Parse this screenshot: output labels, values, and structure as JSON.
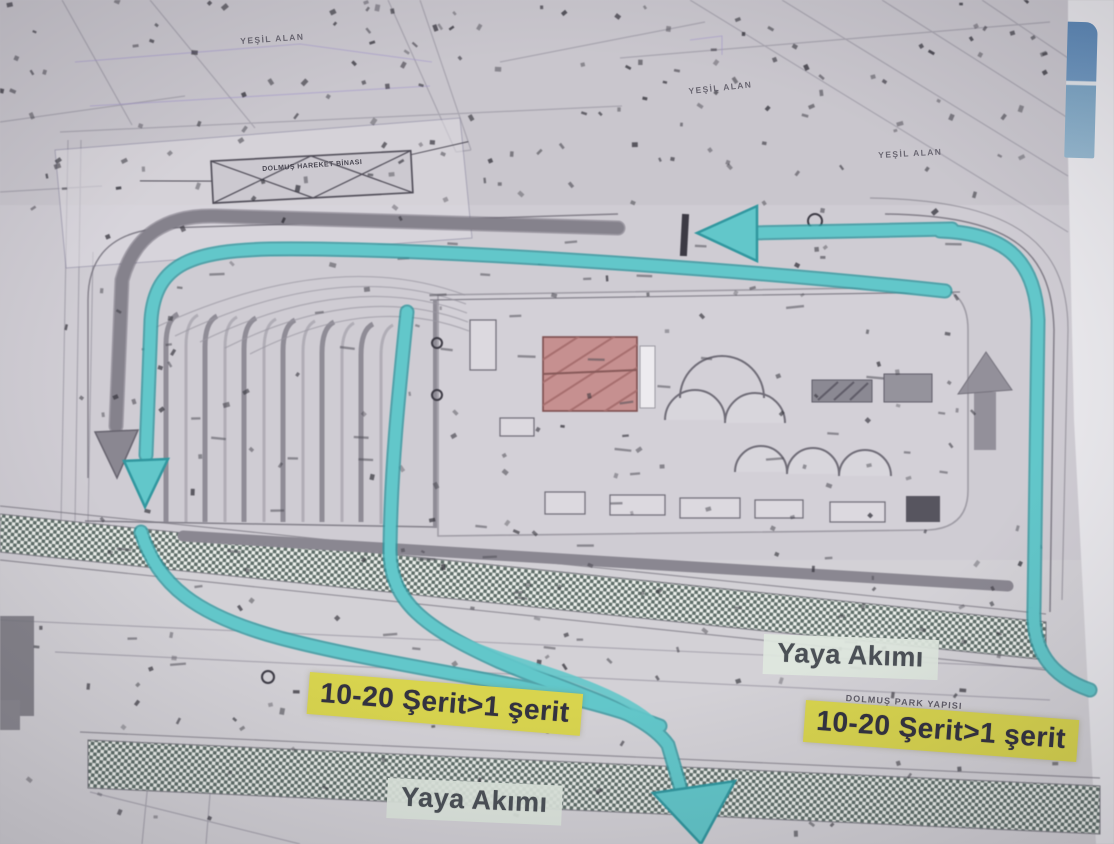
{
  "slide": {
    "plan_labels": {
      "green_area_top_left": "YEŞİL ALAN",
      "green_area_top_center": "YEŞİL ALAN",
      "green_area_top_right": "YEŞİL ALAN",
      "terminal_building": "DOLMUŞ HAREKET BİNASI",
      "parking_structure": "DOLMUŞ PARK YAPISI"
    },
    "annotations": {
      "lane_reduction_left": "10-20 Şerit>1 şerit",
      "lane_reduction_right": "10-20 Şerit>1 şerit",
      "pedestrian_flow_right": "Yaya Akımı",
      "pedestrian_flow_bottom": "Yaya Akımı"
    },
    "colors": {
      "flow_arrow": "#5fc8cb",
      "flow_arrow_edge": "#2e98a0",
      "road_arrow_gray": "#8a8791",
      "lane_label_bg": "#d8d44e",
      "lane_label_text": "#333240",
      "pedestrian_label_bg": "#dee7de",
      "pedestrian_label_text": "#4b5056",
      "building_fill": "#c8908f",
      "screen_edge_blue": "#6b93bd"
    }
  }
}
